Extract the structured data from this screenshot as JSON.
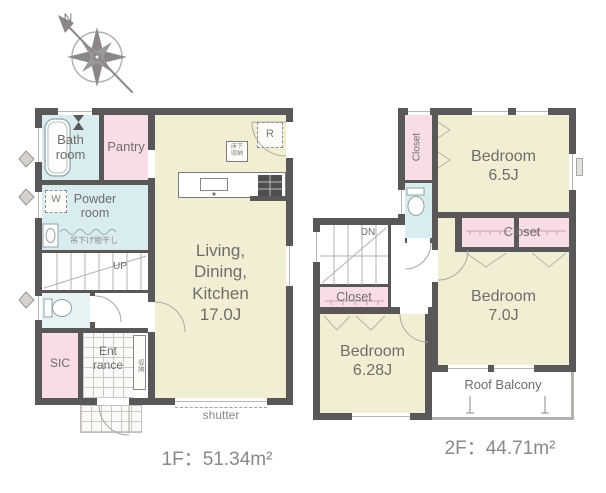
{
  "compass": {
    "north": "N"
  },
  "floor1": {
    "area": "1F：51.34m²",
    "bath": "Bath\nroom",
    "pantry": "Pantry",
    "powder": "Powder\nroom",
    "laundry_pole": "吊下げ物干し",
    "washer": "W",
    "up": "UP",
    "fridge": "R",
    "underfloor": "床下\n収納",
    "ldk": "Living,\nDining,\nKitchen\n17.0J",
    "sic": "SIC",
    "entrance": "Ent\nrance",
    "shoe_storage": "収納",
    "shutter": "shutter"
  },
  "floor2": {
    "area": "2F：44.71m²",
    "closet_side": "Closet",
    "bedroom_65": "Bedroom\n6.5J",
    "closet_main": "Closet",
    "bedroom_70": "Bedroom\n7.0J",
    "closet_stairs": "Closet",
    "bedroom_628": "Bedroom\n6.28J",
    "roof_balcony": "Roof Balcony",
    "down": "DN"
  },
  "colors": {
    "wall": "#595757",
    "room_cream": "#f2eed3",
    "room_pink": "#f9dde4",
    "room_blue": "#d9ecef",
    "label_text": "#6f6d6b"
  }
}
